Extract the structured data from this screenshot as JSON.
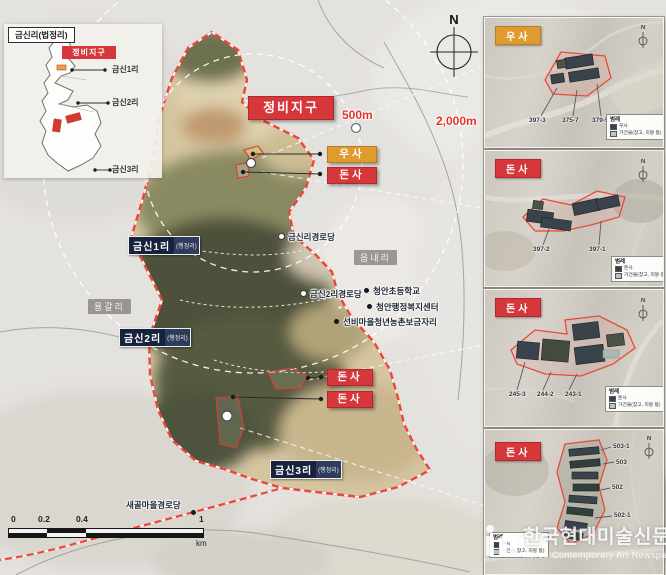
{
  "inset": {
    "title": "금신리(법정리)",
    "chip": "정비지구",
    "points": [
      {
        "label": "금신1리"
      },
      {
        "label": "금신2리"
      },
      {
        "label": "금신3리"
      }
    ]
  },
  "map": {
    "district_chip": "정비지구",
    "compass": "N",
    "rings": [
      {
        "label": "500m"
      },
      {
        "label": "2,000m"
      }
    ],
    "chips": [
      {
        "label": "우사"
      },
      {
        "label": "돈사"
      },
      {
        "label": "돈사"
      },
      {
        "label": "돈사"
      }
    ],
    "admin": [
      {
        "name": "금신1리",
        "suffix": "(행정리)"
      },
      {
        "name": "금신2리",
        "suffix": "(행정리)"
      },
      {
        "name": "금신3리",
        "suffix": "(행정리)"
      }
    ],
    "areas": [
      {
        "label": "용갈리"
      },
      {
        "label": "읍내리"
      }
    ],
    "pois": [
      {
        "label": "금신리경로당"
      },
      {
        "label": "금신2리경로당"
      },
      {
        "label": "청안초등학교"
      },
      {
        "label": "청안행정복지센터"
      },
      {
        "label": "선비마을청년농촌보금자리"
      },
      {
        "label": "새골마을경로당"
      }
    ],
    "scalebar": {
      "ticks": [
        "0",
        "0.2",
        "0.4",
        "1"
      ],
      "unit": "km"
    }
  },
  "panels": [
    {
      "title": "우사",
      "compass": "N",
      "parcels": [
        {
          "no": "397-3"
        },
        {
          "no": "375-7"
        },
        {
          "no": "379-5"
        }
      ],
      "legend": {
        "title": "범례",
        "item1": "우사",
        "item2": "가건물(창고, 지붕 등)"
      }
    },
    {
      "title": "돈사",
      "compass": "N",
      "parcels": [
        {
          "no": "397-2"
        },
        {
          "no": "397-1"
        }
      ],
      "legend": {
        "title": "범례",
        "item1": "돈사",
        "item2": "가건물(창고, 지붕 등)"
      }
    },
    {
      "title": "돈사",
      "compass": "N",
      "parcels": [
        {
          "no": "245-3"
        },
        {
          "no": "244-2"
        },
        {
          "no": "243-1"
        }
      ],
      "legend": {
        "title": "범례",
        "item1": "돈사",
        "item2": "가건물(창고, 지붕 등)"
      }
    },
    {
      "title": "돈사",
      "compass": "N",
      "parcels": [
        {
          "no": "503-1"
        },
        {
          "no": "503"
        },
        {
          "no": "502"
        },
        {
          "no": "502-1"
        }
      ],
      "legend": {
        "title": "범례",
        "item1": "돈사",
        "item2": "가건물(창고, 지붕 등)"
      }
    }
  ],
  "watermark": {
    "title": "한국현대미술신문",
    "subtitle": "Korea Contemporary Art Newspaper"
  },
  "colors": {
    "boundary": "#e84a3a",
    "chip_red": "#d6373a",
    "chip_orange": "#df9b2f",
    "chip_navy": "#17233d",
    "distance_text": "#e0352a"
  }
}
